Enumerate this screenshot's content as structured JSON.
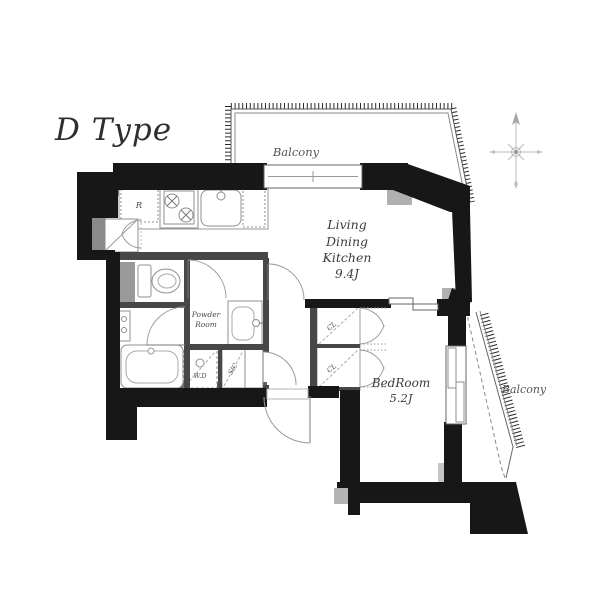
{
  "title": "D Type",
  "labels": {
    "balcony_top": "Balcony",
    "balcony_right": "Balcony",
    "ldk": [
      "Living",
      "Dining",
      "Kitchen",
      "9.4J"
    ],
    "bedroom": [
      "BedRoom",
      "5.2J"
    ],
    "powder_room": [
      "Powder",
      "Room"
    ],
    "washer_dryer": "W.D",
    "shoe_closet": "SIC",
    "refrigerator": "R",
    "closet_upper": "CL",
    "closet_lower": "CL"
  },
  "colors": {
    "wall": "#171717",
    "partition": "#474747",
    "wall_face": "#5f5f5f",
    "accent_gray": "#b3b3b3",
    "pipe_space_gray": "#9a9a9a",
    "fixture_stroke": "#8f8f8f",
    "door_arc": "#9a9a9a",
    "label_text": "#4a4a4a",
    "title_text": "#2e2e2e",
    "compass": "#b8b8b8",
    "background": "#ffffff"
  }
}
